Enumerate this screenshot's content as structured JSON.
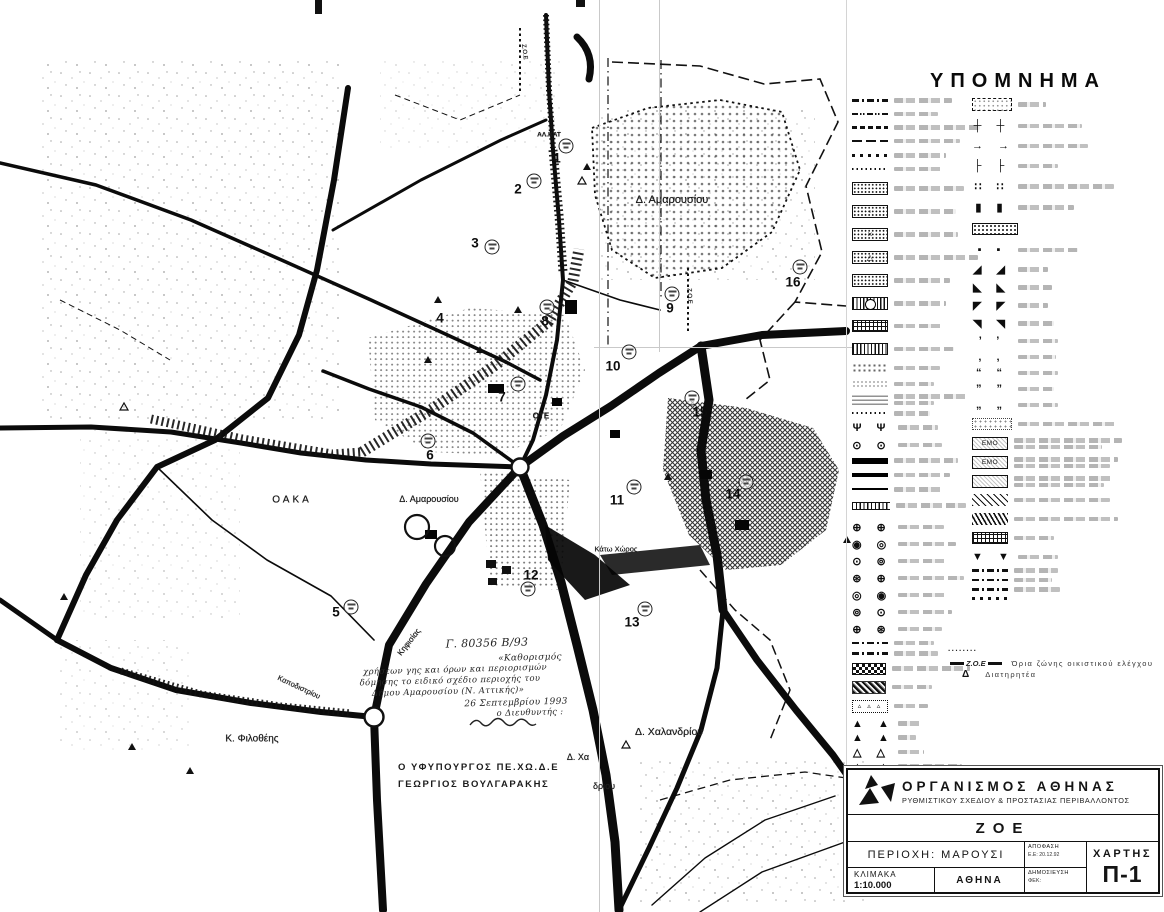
{
  "page": {
    "background": "#ffffff",
    "ink": "#111111",
    "smudge_gray": "#8d8d8d"
  },
  "legend": {
    "title": "ΥΠΟΜΝΗΜΑ",
    "zoe": {
      "dots": "········",
      "symbol": "Ζ.Ο.Ε",
      "text": "Όρια ζώνης οικιστικού ελέγχου"
    },
    "diatiritea": {
      "symbol": "Δ",
      "text": "Διατηρητέα"
    },
    "left_rows": [
      {
        "s": "dashdot",
        "w": 58,
        "mb": 9
      },
      {
        "s": "dashdotdot",
        "w": 44,
        "mb": 9
      },
      {
        "s": "dashbold",
        "w": 86,
        "mb": 9
      },
      {
        "s": "longdash",
        "w": 66,
        "mb": 10
      },
      {
        "s": "sqdots",
        "w": 52,
        "mb": 9
      },
      {
        "s": "finedots",
        "w": 48,
        "mb": 11
      },
      {
        "s": "dotbox",
        "w": 70,
        "mb": 10
      },
      {
        "s": "dotbox",
        "g": "◦",
        "w": 62,
        "mb": 10
      },
      {
        "s": "dotbox",
        "g": "×",
        "w": 64,
        "mb": 10
      },
      {
        "s": "dotbox",
        "g": "△",
        "w": 84,
        "mb": 10
      },
      {
        "s": "dotbox",
        "w": 56,
        "mb": 10
      },
      {
        "s": "circbox",
        "w": 52,
        "mb": 10
      },
      {
        "s": "gridbox",
        "w": 50,
        "mb": 11
      },
      {
        "s": "vhatch",
        "w": 60,
        "mb": 8
      },
      {
        "s": "sparse",
        "w": 46,
        "mb": 7
      },
      {
        "s": "faint",
        "w": 40,
        "mb": 6
      },
      {
        "s": "tinytext",
        "w": 72,
        "w2": 40,
        "mb": 6
      },
      {
        "s": "finedots",
        "w": 36,
        "mb": 6
      },
      {
        "s": "pairglyph",
        "g": "Ψ Ψ",
        "w": 40,
        "mb": 5
      },
      {
        "s": "pairglyph",
        "g": "⊙ ⊙",
        "w": 44,
        "mb": 6
      },
      {
        "s": "thick",
        "w": 64,
        "mb": 9
      },
      {
        "s": "med",
        "w": 56,
        "mb": 10
      },
      {
        "s": "thin",
        "w": 50,
        "mb": 10
      },
      {
        "s": "ties",
        "w": 70,
        "mb": 11
      },
      {
        "s": "pairglyph",
        "g": "⊕ ⊕",
        "w": 46,
        "mb": 4
      },
      {
        "s": "pairglyph",
        "g": "◉ ◎",
        "w": 58,
        "mb": 4
      },
      {
        "s": "pairglyph",
        "g": "⊙ ⊚",
        "w": 50,
        "mb": 4
      },
      {
        "s": "pairglyph",
        "g": "⊛ ⊕",
        "w": 66,
        "mb": 4
      },
      {
        "s": "pairglyph",
        "g": "◎ ◉",
        "w": 48,
        "mb": 4
      },
      {
        "s": "pairglyph",
        "g": "⊚ ⊙",
        "w": 54,
        "mb": 4
      },
      {
        "s": "pairglyph",
        "g": "⊕ ⊛",
        "w": 44,
        "mb": 5
      },
      {
        "s": "dashdot",
        "w": 40,
        "mb": 6
      },
      {
        "s": "dashdot",
        "w": 44,
        "mb": 7
      },
      {
        "s": "check",
        "w": 78,
        "mb": 6
      },
      {
        "s": "noise",
        "w": 40,
        "mb": 6
      },
      {
        "s": "tribox",
        "g": "▵ ▵ ▵",
        "w": 34,
        "mb": 5
      },
      {
        "s": "pairglyph",
        "g": "▲ ▲",
        "w": 22,
        "mb": 2
      },
      {
        "s": "pairglyph",
        "g": "▲ ▲",
        "w": 18,
        "mb": 2
      },
      {
        "s": "pairglyph",
        "g": "△ △",
        "w": 26,
        "mb": 2
      },
      {
        "s": "pairglyph",
        "g": "▲ ▲",
        "w": 64,
        "mb": 2
      },
      {
        "s": "pairglyph",
        "g": "△ △",
        "w": 70,
        "mb": 2
      },
      {
        "s": "pairglyph",
        "g": "▲ ▲",
        "w": 52,
        "mb": 2
      },
      {
        "s": "pairglyph",
        "g": "△ △",
        "w": 30,
        "mb": 2
      },
      {
        "s": "pairglyph",
        "g": "▲ ▲",
        "w": 40,
        "mb": 2
      }
    ],
    "right_rows": [
      {
        "s": "dashbox",
        "w": 28,
        "mb": 9
      },
      {
        "s": "pairglyph",
        "g": "┼ ┼",
        "w": 64,
        "mb": 8
      },
      {
        "s": "pairglyph",
        "g": "→ →",
        "w": 70,
        "mb": 8
      },
      {
        "s": "pairglyph",
        "g": "├ ├",
        "w": 40,
        "mb": 8
      },
      {
        "s": "pairglyph",
        "g": "∷ ∷",
        "w": 96,
        "mb": 8
      },
      {
        "s": "pairglyph",
        "g": "▮ ▮",
        "w": 56,
        "mb": 9
      },
      {
        "s": "dotboxwide",
        "w": 0,
        "mb": 9
      },
      {
        "s": "pairglyph",
        "g": "▪ ▪",
        "w": 60,
        "mb": 7
      },
      {
        "s": "pairglyph",
        "g": "◢ ◢",
        "w": 30,
        "mb": 5
      },
      {
        "s": "pairglyph",
        "g": "◣ ◣",
        "w": 34,
        "mb": 5
      },
      {
        "s": "pairglyph",
        "g": "◤ ◤",
        "w": 30,
        "mb": 5
      },
      {
        "s": "pairglyph",
        "g": "◥ ◥",
        "w": 36,
        "mb": 5
      },
      {
        "s": "pairglyph",
        "g": "’ ’",
        "w": 40,
        "mb": 4
      },
      {
        "s": "pairglyph",
        "g": "‚ ‚",
        "w": 38,
        "mb": 4
      },
      {
        "s": "pairglyph",
        "g": "“ “",
        "w": 40,
        "mb": 4
      },
      {
        "s": "pairglyph",
        "g": "” ”",
        "w": 36,
        "mb": 4
      },
      {
        "s": "pairglyph",
        "g": "„ „",
        "w": 40,
        "mb": 7
      },
      {
        "s": "sparse2",
        "w": 100,
        "mb": 7
      },
      {
        "s": "emo",
        "g": "ΕΜΟ",
        "w": 108,
        "w2": 88,
        "mb": 6
      },
      {
        "s": "emo",
        "g": "ΕΜΟ",
        "w": 104,
        "w2": 96,
        "mb": 6
      },
      {
        "s": "emo",
        "w": 100,
        "w2": 90,
        "mb": 6
      },
      {
        "s": "diag",
        "w": 96,
        "mb": 7
      },
      {
        "s": "diag2",
        "w": 104,
        "mb": 7
      },
      {
        "s": "gridbox",
        "w": 40,
        "mb": 7
      },
      {
        "s": "pairglyph",
        "g": "▼ ▼",
        "w": 40,
        "mb": 5
      },
      {
        "s": "dashdot",
        "w": 44,
        "mb": 5
      },
      {
        "s": "dashdot",
        "w": 38,
        "mb": 5
      },
      {
        "s": "dashdot",
        "w": 46,
        "mb": 5
      },
      {
        "s": "sqdots",
        "w": 0,
        "mb": 4
      }
    ]
  },
  "map": {
    "labels": [
      {
        "t": "Δ. Αμαρουσίου",
        "x": 672,
        "y": 200,
        "s": 11
      },
      {
        "t": "Δ. Αμαρουσίου",
        "x": 429,
        "y": 499,
        "s": 9
      },
      {
        "t": "ΟΑΚΑ",
        "x": 292,
        "y": 500,
        "s": 10,
        "ls": 3
      },
      {
        "t": "ΟΤΕ",
        "x": 541,
        "y": 416,
        "s": 8,
        "b": 1
      },
      {
        "t": "Κ. Φιλοθέης",
        "x": 252,
        "y": 739,
        "s": 10
      },
      {
        "t": "Δ. Χαλανδρίου",
        "x": 669,
        "y": 732,
        "s": 10.5
      },
      {
        "t": "Κάτω Χώρος",
        "x": 616,
        "y": 549,
        "s": 7.5
      },
      {
        "t": "ΑΛ.ΚΑΤ",
        "x": 549,
        "y": 135,
        "s": 6.5,
        "b": 1
      },
      {
        "t": "Κηφισίας",
        "x": 409,
        "y": 642,
        "s": 8,
        "r": -52
      },
      {
        "t": "Καποδιστρίου",
        "x": 299,
        "y": 687,
        "s": 7.5,
        "r": 25
      },
      {
        "t": "Δ. Χα",
        "x": 578,
        "y": 757,
        "s": 9
      },
      {
        "t": "δριου",
        "x": 604,
        "y": 786,
        "s": 9
      },
      {
        "t": "Ζ.Ο.Ε",
        "x": 524,
        "y": 52,
        "s": 6,
        "r": 83
      },
      {
        "t": "Ζ.Ο.Ε",
        "x": 689,
        "y": 296,
        "s": 6,
        "r": 87
      }
    ],
    "zones": [
      {
        "n": "1",
        "x": 557,
        "y": 158,
        "cx": 566,
        "cy": 146
      },
      {
        "n": "2",
        "x": 518,
        "y": 189,
        "cx": 534,
        "cy": 181
      },
      {
        "n": "3",
        "x": 475,
        "y": 243,
        "cx": 492,
        "cy": 247
      },
      {
        "n": "4",
        "x": 440,
        "y": 318
      },
      {
        "n": "5",
        "x": 336,
        "y": 612,
        "cx": 351,
        "cy": 607
      },
      {
        "n": "6",
        "x": 430,
        "y": 455,
        "cx": 428,
        "cy": 441
      },
      {
        "n": "7",
        "x": 502,
        "y": 397,
        "cx": 518,
        "cy": 384
      },
      {
        "n": "8",
        "x": 545,
        "y": 321,
        "cx": 547,
        "cy": 307
      },
      {
        "n": "9",
        "x": 670,
        "y": 308,
        "cx": 672,
        "cy": 294
      },
      {
        "n": "10",
        "x": 613,
        "y": 366,
        "cx": 629,
        "cy": 352
      },
      {
        "n": "11",
        "x": 617,
        "y": 500,
        "cx": 634,
        "cy": 487
      },
      {
        "n": "12",
        "x": 531,
        "y": 575,
        "cx": 528,
        "cy": 589
      },
      {
        "n": "13",
        "x": 632,
        "y": 622,
        "cx": 645,
        "cy": 609
      },
      {
        "n": "14",
        "x": 733,
        "y": 494,
        "cx": 746,
        "cy": 482
      },
      {
        "n": "15",
        "x": 700,
        "y": 412,
        "cx": 692,
        "cy": 398
      },
      {
        "n": "16",
        "x": 793,
        "y": 282,
        "cx": 800,
        "cy": 267
      }
    ],
    "handwriting": [
      {
        "t": "Γ. 80356 Β/93",
        "x": 487,
        "y": 643,
        "s": 11
      },
      {
        "t": "«Καθορισμός",
        "x": 530,
        "y": 658,
        "s": 9
      },
      {
        "t": "χρήσεων γης και όρων και περιορισμών",
        "x": 455,
        "y": 670,
        "s": 8.5
      },
      {
        "t": "δόμησης το ειδικό σχέδιο περιοχής του",
        "x": 450,
        "y": 681,
        "s": 8.5
      },
      {
        "t": "Δήμου Αμαρουσίου (Ν. Αττικής)»",
        "x": 448,
        "y": 692,
        "s": 8.5
      },
      {
        "t": "26 Σεπτεμβρίου 1993",
        "x": 516,
        "y": 703,
        "s": 9
      },
      {
        "t": "ο Διευθυντής :",
        "x": 530,
        "y": 713,
        "s": 8.5
      }
    ],
    "minister_line1": "Ο ΥΦΥΠΟΥΡΓΟΣ ΠΕ.ΧΩ.Δ.Ε",
    "minister_line2": "ΓΕΩΡΓΙΟΣ ΒΟΥΛΓΑΡΑΚΗΣ"
  },
  "title_block": {
    "org_line1": "ΟΡΓΑΝΙΣΜΟΣ ΑΘΗΝΑΣ",
    "org_line2": "ΡΥΘΜΙΣΤΙΚΟΥ ΣΧΕΔΙΟΥ & ΠΡΟΣΤΑΣΙΑΣ ΠΕΡΙΒΑΛΛΟΝΤΟΣ",
    "zoe": "ΖΟΕ",
    "region": "ΠΕΡΙΟΧΗ: ΜΑΡΟΥΣΙ",
    "decision_label": "ΑΠΟΦΑΣΗ",
    "decision_value": "Ε.Ε: 20.12.92",
    "chart_label": "ΧΑΡΤΗΣ",
    "chart_code": "Π-1",
    "scale_label": "ΚΛΙΜΑΚΑ",
    "scale_value": "1:10.000",
    "city": "ΑΘΗΝΑ",
    "publication_label": "ΔΗΜΟΣΙΕΥΣΗ",
    "publication_value": "ΦΕΚ:"
  }
}
